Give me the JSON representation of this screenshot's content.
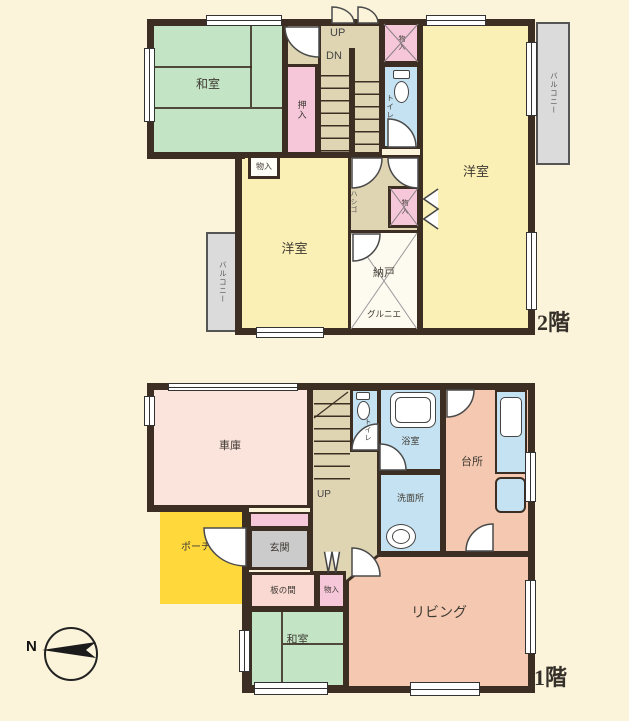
{
  "floor2": {
    "floor_label": "2階",
    "rooms": {
      "washitsu": "和室",
      "oshiire": "押入",
      "closet_small": "物入",
      "closet_top": "物入",
      "closet_mid": "物入",
      "toilet": "トイレ",
      "yoshitsu_left": "洋室",
      "yoshitsu_right": "洋室",
      "hashigo": "ハシゴ",
      "nando": "納戸",
      "grenier": "グルニエ",
      "balcony_left": "バルコニー",
      "balcony_right": "バルコニー"
    },
    "stairs": {
      "up": "UP",
      "down": "DN"
    }
  },
  "floor1": {
    "floor_label": "1階",
    "rooms": {
      "garage": "車庫",
      "porch": "ポーチ",
      "entrance": "玄関",
      "itanoma": "板の間",
      "closet": "物入",
      "washitsu": "和室",
      "living": "リビング",
      "kitchen": "台所",
      "bath": "浴室",
      "washroom": "洗面所",
      "toilet": "トイレ"
    },
    "stairs": {
      "up": "UP"
    }
  },
  "compass": {
    "north": "N"
  },
  "palette": {
    "background": "#FBF4DB",
    "wall": "#3C2E22",
    "tatami_green": "#C3E5C5",
    "room_yellow": "#FAF0B5",
    "closet_pink": "#F5C7D9",
    "hall_tan": "#DFD5B3",
    "water_blue": "#C4E2F2",
    "garage_blush": "#FAE4DB",
    "living_salmon": "#F5C9B1",
    "porch_yellow": "#FFD93B",
    "entrance_gray": "#CBCBCB",
    "balcony_gray": "#DBDBDB"
  }
}
